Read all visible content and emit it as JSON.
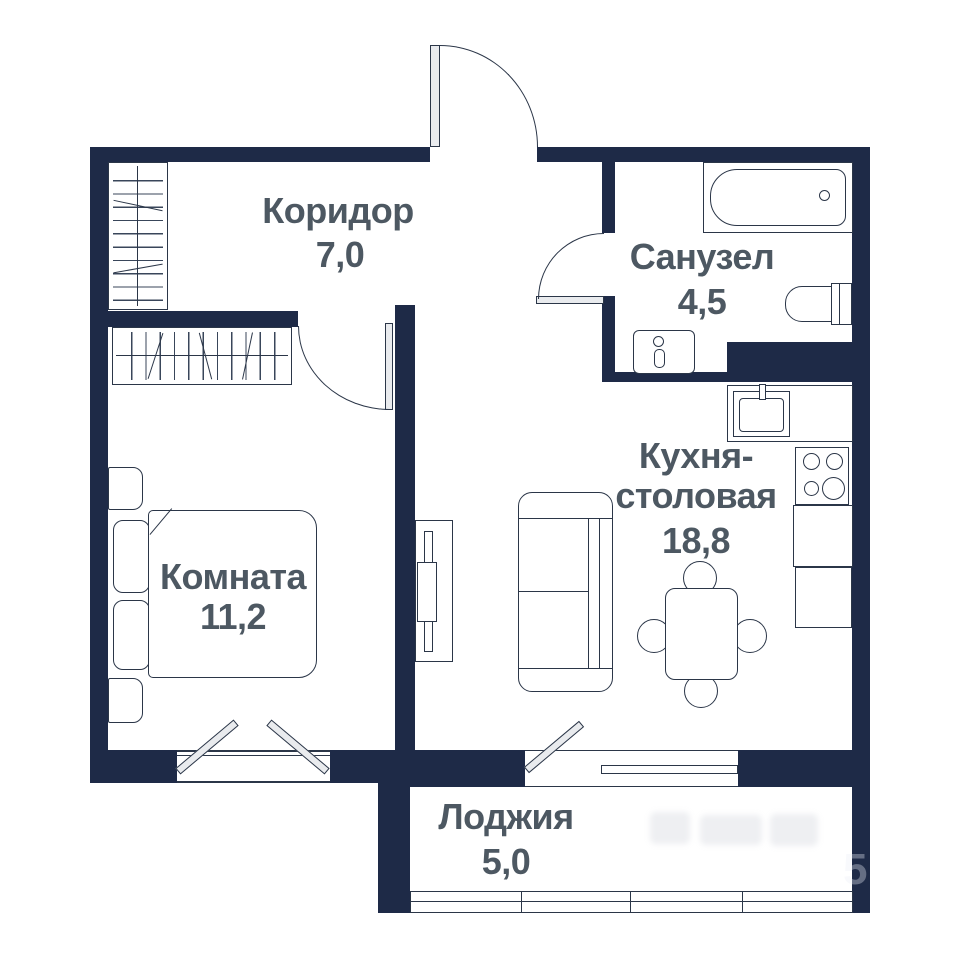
{
  "floor_plan": {
    "rooms": {
      "corridor": {
        "name": "Коридор",
        "area": "7,0"
      },
      "bathroom": {
        "name": "Санузел",
        "area": "4,5"
      },
      "kitchen_dining": {
        "name_line1": "Кухня-",
        "name_line2": "столовая",
        "area": "18,8"
      },
      "room": {
        "name": "Комната",
        "area": "11,2"
      },
      "loggia": {
        "name": "Лоджия",
        "area": "5,0"
      }
    },
    "fixtures": {
      "bathroom": [
        "bathtub",
        "toilet",
        "washbasin"
      ],
      "kitchen_dining": [
        "kitchen-sink",
        "stove",
        "counter",
        "dining-table",
        "chairs",
        "sofa",
        "tv-unit"
      ],
      "room": [
        "bed",
        "pillows",
        "nightstands",
        "wardrobe"
      ],
      "corridor": [
        "wardrobe"
      ],
      "loggia": [
        "glazing"
      ]
    },
    "doors": [
      "entrance-door",
      "bathroom-door",
      "room-door",
      "balcony-door"
    ],
    "windows": [
      "room-window",
      "kitchen-window",
      "loggia-glazing"
    ],
    "colors": {
      "wall": "#1e2a47",
      "label_text": "#4d5862",
      "outline": "#2b3648",
      "background": "#ffffff"
    },
    "watermark": {
      "digit": "5"
    }
  }
}
